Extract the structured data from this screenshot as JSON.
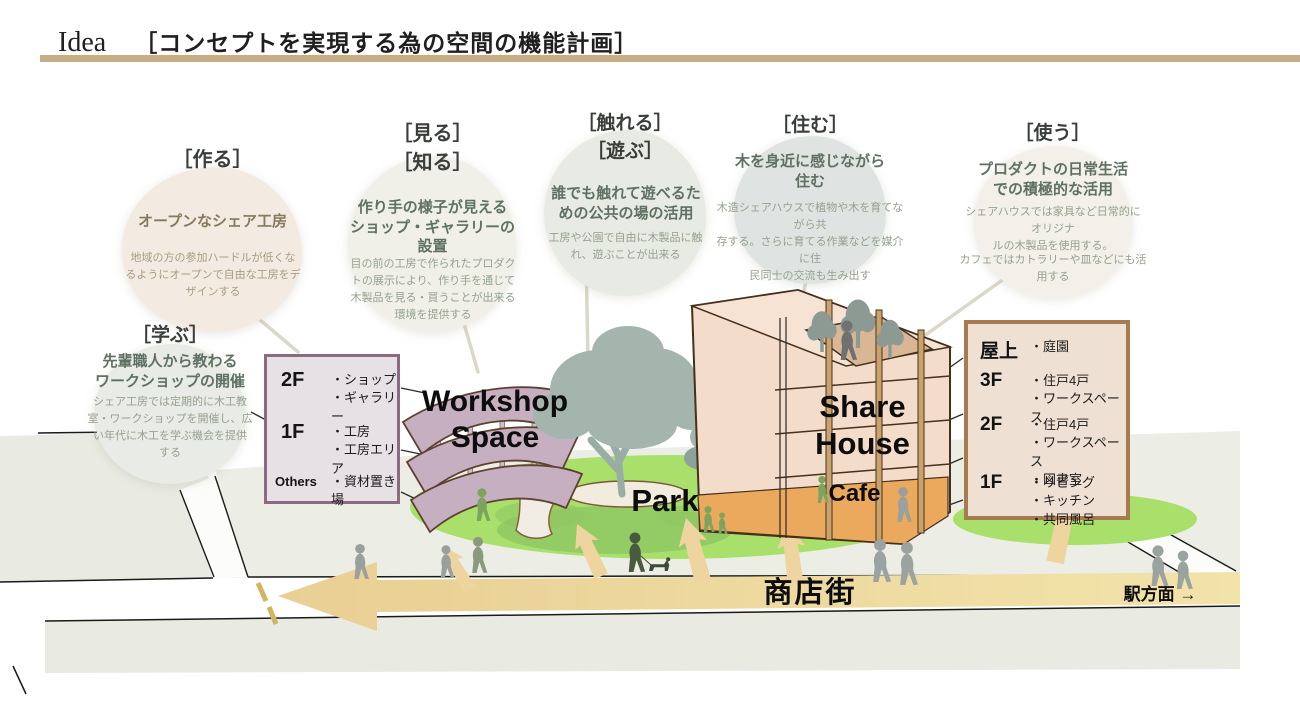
{
  "title": {
    "word": "Idea",
    "subtitle": "［コンセプトを実現する為の空間の機能計画］"
  },
  "bubbles": {
    "make": {
      "tag": "［作る］",
      "heading": "オープンなシェア工房",
      "body": "地域の方の参加ハードルが低くな\nるようにオープンで自由な工房をデ\nザインする"
    },
    "learn": {
      "tag": "［学ぶ］",
      "heading": "先輩職人から教わる\nワークショップの開催",
      "body": "シェア工房では定期的に木工教\n室・ワークショップを開催し、広\nい年代に木工を学ぶ機会を提供\nする"
    },
    "see": {
      "tag": "［見る］\n［知る］",
      "heading": "作り手の様子が見える\nショップ・ギャラリーの\n設置",
      "body": "目の前の工房で作られたプロダク\nトの展示により、作り手を通じて\n木製品を見る・買うことが出来る\n環境を提供する"
    },
    "touch": {
      "tag": "［触れる］\n［遊ぶ］",
      "heading": "誰でも触れて遊べるた\nめの公共の場の活用",
      "body": "工房や公園で自由に木製品に触\nれ、遊ぶことが出来る"
    },
    "live": {
      "tag": "［住む］",
      "heading": "木を身近に感じながら\n住む",
      "body": "木造シェアハウスで植物や木を育てながら共\n存する。さらに育てる作業などを媒介に住\n民同士の交流も生み出す"
    },
    "use": {
      "tag": "［使う］",
      "heading": "プロダクトの日常生活\nでの積極的な活用",
      "body": "シェアハウスでは家具など日常的にオリジナ\nルの木製品を使用する。",
      "body2": "カフェではカトラリーや皿などにも活用する"
    }
  },
  "boxes": {
    "workshop": {
      "rows": [
        {
          "floor": "2F",
          "items": "・ショップ\n・ギャラリー"
        },
        {
          "floor": "1F",
          "items": "・工房\n・工房エリア"
        },
        {
          "floor": "Others",
          "items": "・資材置き場"
        }
      ]
    },
    "sharehouse": {
      "rows": [
        {
          "floor": "屋上",
          "items": "・庭園"
        },
        {
          "floor": "3F",
          "items": "・住戸4戸\n・ワークスペース"
        },
        {
          "floor": "2F",
          "items": "・住戸4戸\n・ワークスペース\n・図書室"
        },
        {
          "floor": "1F",
          "items": "・リビング\n・キッチン\n・共同風呂"
        }
      ]
    }
  },
  "map_labels": {
    "workshop": "Workshop\nSpace",
    "sharehouse": "Share\nHouse",
    "park": "Park",
    "cafe": "Cafe",
    "street": "商店街",
    "station": "駅方面 →"
  },
  "colors": {
    "title_rule": "#c6ad85",
    "street_arrow": "#ecd49c",
    "park_green": "#a9e06c",
    "workshop_purple": "#c7afc2",
    "sharehouse_wall": "#f4dcca",
    "roof_garden": "#d9b795",
    "cafe_orange": "#eba95d",
    "ground_gray": "#e9eae1",
    "workshop_box_border": "#8e6a80",
    "sharehouse_box_border": "#a87a50"
  }
}
